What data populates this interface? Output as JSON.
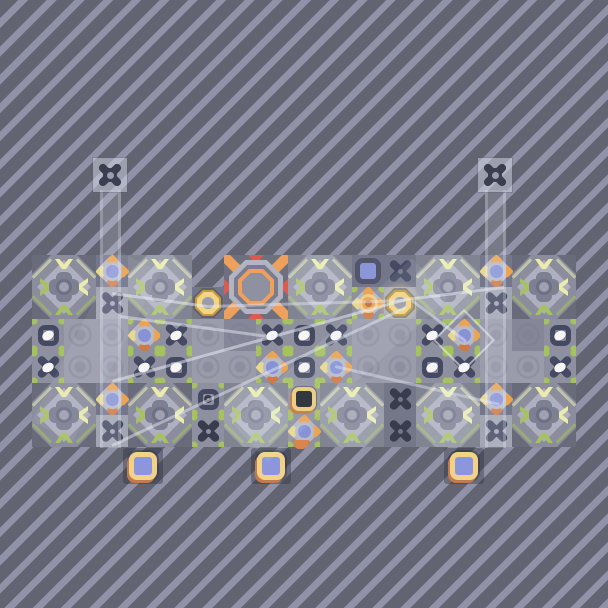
{
  "scene": {
    "name": "tile-puzzle-level",
    "width": 608,
    "height": 608,
    "background": {
      "stripe_dark": "#626472",
      "stripe_light": "#9093a7",
      "stripe_dark_px": 13,
      "stripe_light_px": 7,
      "angle_deg": 135
    }
  },
  "colors": {
    "tile_base": "#8b8d9d",
    "tile_diamond": "#aeb0bf",
    "tile_corner": "#696b7b",
    "tile_blob": "#7d7f93",
    "tile_dot": "#9fa1b2",
    "tile_dot_ring": "#6e7084",
    "green": "#a6c25c",
    "pale": "#e9ecab",
    "streak": "rgba(236,240,180,0.55)",
    "glyph": "#454961",
    "glyph_dark": "#383c4c",
    "turret_glyph": "#3a3e4e",
    "egg": "#f3f5f7",
    "cell_strip": "#8e90a0",
    "cell_dark": "#74768a",
    "cell_light": "#a3a5b3",
    "cell_plain": "#9a9cac",
    "cell_plain_dark": "#858798",
    "flower_blue": "#8893d6",
    "flower_ring": "#b9bbc8",
    "flower_diamond": "#b5b7c5",
    "petal_orange": "#eba452",
    "petal_deep": "#cf7a43",
    "petal_yellow": "#e8d98d",
    "ring_gold_edge": "#c79a33",
    "ring_gold": "#f0d488",
    "ring_hole": "#9a9cab",
    "blue_square_fill": "#8b96d8",
    "blue_square_border": "#53566a",
    "black_square_fill": "#22252e",
    "black_square_ring": "#ecca7d",
    "black_square_accent": "#c8743f",
    "pedestal_ring": "#f2d288",
    "pedestal_accent": "#c27a50",
    "pedestal_fill": "#8b97da",
    "pedestal_shadow": "rgba(42,44,58,0.38)",
    "octagon_bg": "#6e7080",
    "octagon_orange": "#efa05c",
    "octagon_red": "#d85c50",
    "octagon_light": "#b2b4c2",
    "octagon_mid": "#7b7d8e",
    "octagon_center": "#8f91a1",
    "beam_line": "238,241,250",
    "tower_head_bg": "rgba(213,217,230,0.5)"
  },
  "board": {
    "x": 32,
    "y": 255,
    "width": 546,
    "height": 192,
    "notch": {
      "x": 192,
      "y": 255,
      "width": 32,
      "height": 32
    }
  },
  "large_tiles": [
    {
      "x": 32,
      "y": 255,
      "washed": false
    },
    {
      "x": 128,
      "y": 255,
      "washed": true
    },
    {
      "x": 288,
      "y": 255,
      "washed": true
    },
    {
      "x": 416,
      "y": 255,
      "washed": true
    },
    {
      "x": 512,
      "y": 255,
      "washed": false
    },
    {
      "x": 32,
      "y": 383,
      "washed": false
    },
    {
      "x": 128,
      "y": 383,
      "washed": false
    },
    {
      "x": 224,
      "y": 383,
      "washed": true
    },
    {
      "x": 320,
      "y": 383,
      "washed": true
    },
    {
      "x": 416,
      "y": 383,
      "washed": true
    },
    {
      "x": 512,
      "y": 383,
      "washed": false
    }
  ],
  "octagon_target": {
    "x": 224,
    "y": 255,
    "size": 64
  },
  "cells": [
    {
      "x": 96,
      "y": 255,
      "type": "flower",
      "bg": "dark"
    },
    {
      "x": 96,
      "y": 287,
      "type": "xcross",
      "bg": "light"
    },
    {
      "x": 96,
      "y": 383,
      "type": "flower",
      "bg": "dark"
    },
    {
      "x": 96,
      "y": 415,
      "type": "xcross",
      "bg": "light"
    },
    {
      "x": 480,
      "y": 255,
      "type": "flower",
      "bg": "dark"
    },
    {
      "x": 480,
      "y": 287,
      "type": "xcross",
      "bg": "light"
    },
    {
      "x": 480,
      "y": 383,
      "type": "flower",
      "bg": "dark"
    },
    {
      "x": 480,
      "y": 415,
      "type": "xcross",
      "bg": "light"
    },
    {
      "x": 352,
      "y": 255,
      "type": "bluesquare",
      "bg": "dark"
    },
    {
      "x": 384,
      "y": 255,
      "type": "xcross",
      "bg": "dark"
    },
    {
      "x": 352,
      "y": 287,
      "type": "oflower",
      "bg": "strip"
    },
    {
      "x": 384,
      "y": 287,
      "type": "yring_glow",
      "bg": "light"
    },
    {
      "x": 192,
      "y": 287,
      "type": "yring",
      "bg": "dark"
    },
    {
      "x": 192,
      "y": 383,
      "type": "socket",
      "bg": "strip"
    },
    {
      "x": 192,
      "y": 415,
      "type": "xcross_dark",
      "bg": "strip"
    },
    {
      "x": 288,
      "y": 383,
      "type": "blacksquare",
      "bg": "strip"
    },
    {
      "x": 288,
      "y": 415,
      "type": "flower",
      "bg": "strip"
    },
    {
      "x": 384,
      "y": 383,
      "type": "xcross_dark",
      "bg": "dark"
    },
    {
      "x": 384,
      "y": 415,
      "type": "xcross_dark",
      "bg": "dark"
    },
    {
      "x": 32,
      "y": 319,
      "type": "eyesocket",
      "bg": "strip"
    },
    {
      "x": 64,
      "y": 319,
      "type": "plain"
    },
    {
      "x": 96,
      "y": 319,
      "type": "plain"
    },
    {
      "x": 128,
      "y": 319,
      "type": "flower",
      "bg": "strip"
    },
    {
      "x": 160,
      "y": 319,
      "type": "xegg",
      "bg": "strip"
    },
    {
      "x": 192,
      "y": 319,
      "type": "plain"
    },
    {
      "x": 224,
      "y": 319,
      "type": "plain_dark"
    },
    {
      "x": 256,
      "y": 319,
      "type": "xegg",
      "bg": "strip"
    },
    {
      "x": 288,
      "y": 319,
      "type": "eyesocket",
      "bg": "strip"
    },
    {
      "x": 320,
      "y": 319,
      "type": "xegg",
      "bg": "strip"
    },
    {
      "x": 352,
      "y": 319,
      "type": "plain"
    },
    {
      "x": 384,
      "y": 319,
      "type": "plain"
    },
    {
      "x": 416,
      "y": 319,
      "type": "xegg",
      "bg": "strip"
    },
    {
      "x": 448,
      "y": 319,
      "type": "flower",
      "bg": "strip"
    },
    {
      "x": 480,
      "y": 319,
      "type": "plain"
    },
    {
      "x": 512,
      "y": 319,
      "type": "plain_dark"
    },
    {
      "x": 544,
      "y": 319,
      "type": "eyesocket",
      "bg": "strip"
    },
    {
      "x": 32,
      "y": 351,
      "type": "xegg",
      "bg": "strip"
    },
    {
      "x": 64,
      "y": 351,
      "type": "plain"
    },
    {
      "x": 96,
      "y": 351,
      "type": "plain"
    },
    {
      "x": 128,
      "y": 351,
      "type": "xegg",
      "bg": "strip"
    },
    {
      "x": 160,
      "y": 351,
      "type": "eyesocket",
      "bg": "strip"
    },
    {
      "x": 192,
      "y": 351,
      "type": "plain"
    },
    {
      "x": 224,
      "y": 351,
      "type": "plain"
    },
    {
      "x": 256,
      "y": 351,
      "type": "flower",
      "bg": "strip"
    },
    {
      "x": 288,
      "y": 351,
      "type": "eyesocket",
      "bg": "strip"
    },
    {
      "x": 320,
      "y": 351,
      "type": "flower",
      "bg": "strip"
    },
    {
      "x": 352,
      "y": 351,
      "type": "plain"
    },
    {
      "x": 384,
      "y": 351,
      "type": "plain"
    },
    {
      "x": 416,
      "y": 351,
      "type": "eyesocket",
      "bg": "strip"
    },
    {
      "x": 448,
      "y": 351,
      "type": "xegg",
      "bg": "strip"
    },
    {
      "x": 480,
      "y": 351,
      "type": "plain"
    },
    {
      "x": 512,
      "y": 351,
      "type": "plain"
    },
    {
      "x": 544,
      "y": 351,
      "type": "xegg",
      "bg": "strip"
    }
  ],
  "towers": [
    {
      "side": "left",
      "head_x": 93,
      "head_y": 158,
      "head_size": 34,
      "beam_x": 100,
      "beam_top": 190,
      "beam_bottom": 448,
      "beam_width": 21
    },
    {
      "side": "right",
      "head_x": 478,
      "head_y": 158,
      "head_size": 34,
      "beam_x": 485,
      "beam_top": 190,
      "beam_bottom": 448,
      "beam_width": 21
    }
  ],
  "beam_lines": [
    {
      "x1": 112,
      "y1": 293,
      "x2": 208,
      "y2": 306,
      "w": 3,
      "o": 0.5
    },
    {
      "x1": 208,
      "y1": 306,
      "x2": 406,
      "y2": 300,
      "w": 2.5,
      "o": 0.4
    },
    {
      "x1": 120,
      "y1": 316,
      "x2": 268,
      "y2": 336,
      "w": 2.5,
      "o": 0.45
    },
    {
      "x1": 406,
      "y1": 299,
      "x2": 112,
      "y2": 381,
      "w": 3,
      "o": 0.5
    },
    {
      "x1": 406,
      "y1": 307,
      "x2": 112,
      "y2": 445,
      "w": 3,
      "o": 0.45
    },
    {
      "x1": 406,
      "y1": 299,
      "x2": 504,
      "y2": 287,
      "w": 3,
      "o": 0.5
    },
    {
      "x1": 335,
      "y1": 366,
      "x2": 500,
      "y2": 404,
      "w": 2.5,
      "o": 0.4
    },
    {
      "x1": 412,
      "y1": 300,
      "x2": 466,
      "y2": 341,
      "w": 2.5,
      "o": 0.45
    }
  ],
  "washes": [
    {
      "x1": 430,
      "y1": 278,
      "x2": 250,
      "y2": 442,
      "w": 54,
      "o": 0.09
    },
    {
      "x1": 140,
      "y1": 262,
      "x2": 52,
      "y2": 432,
      "w": 46,
      "o": 0.07
    }
  ],
  "diamond_outlines": [
    {
      "cx": 464,
      "cy": 340,
      "size": 44
    }
  ],
  "orange_tab": {
    "x": 294,
    "y": 440,
    "w": 14,
    "h": 9
  },
  "pedestals": [
    {
      "x": 123,
      "y": 448,
      "w": 40,
      "h": 36,
      "item_cx": 143,
      "item_cy": 466
    },
    {
      "x": 251,
      "y": 448,
      "w": 40,
      "h": 36,
      "item_cx": 271,
      "item_cy": 466
    },
    {
      "x": 444,
      "y": 448,
      "w": 40,
      "h": 36,
      "item_cx": 464,
      "item_cy": 466
    }
  ]
}
